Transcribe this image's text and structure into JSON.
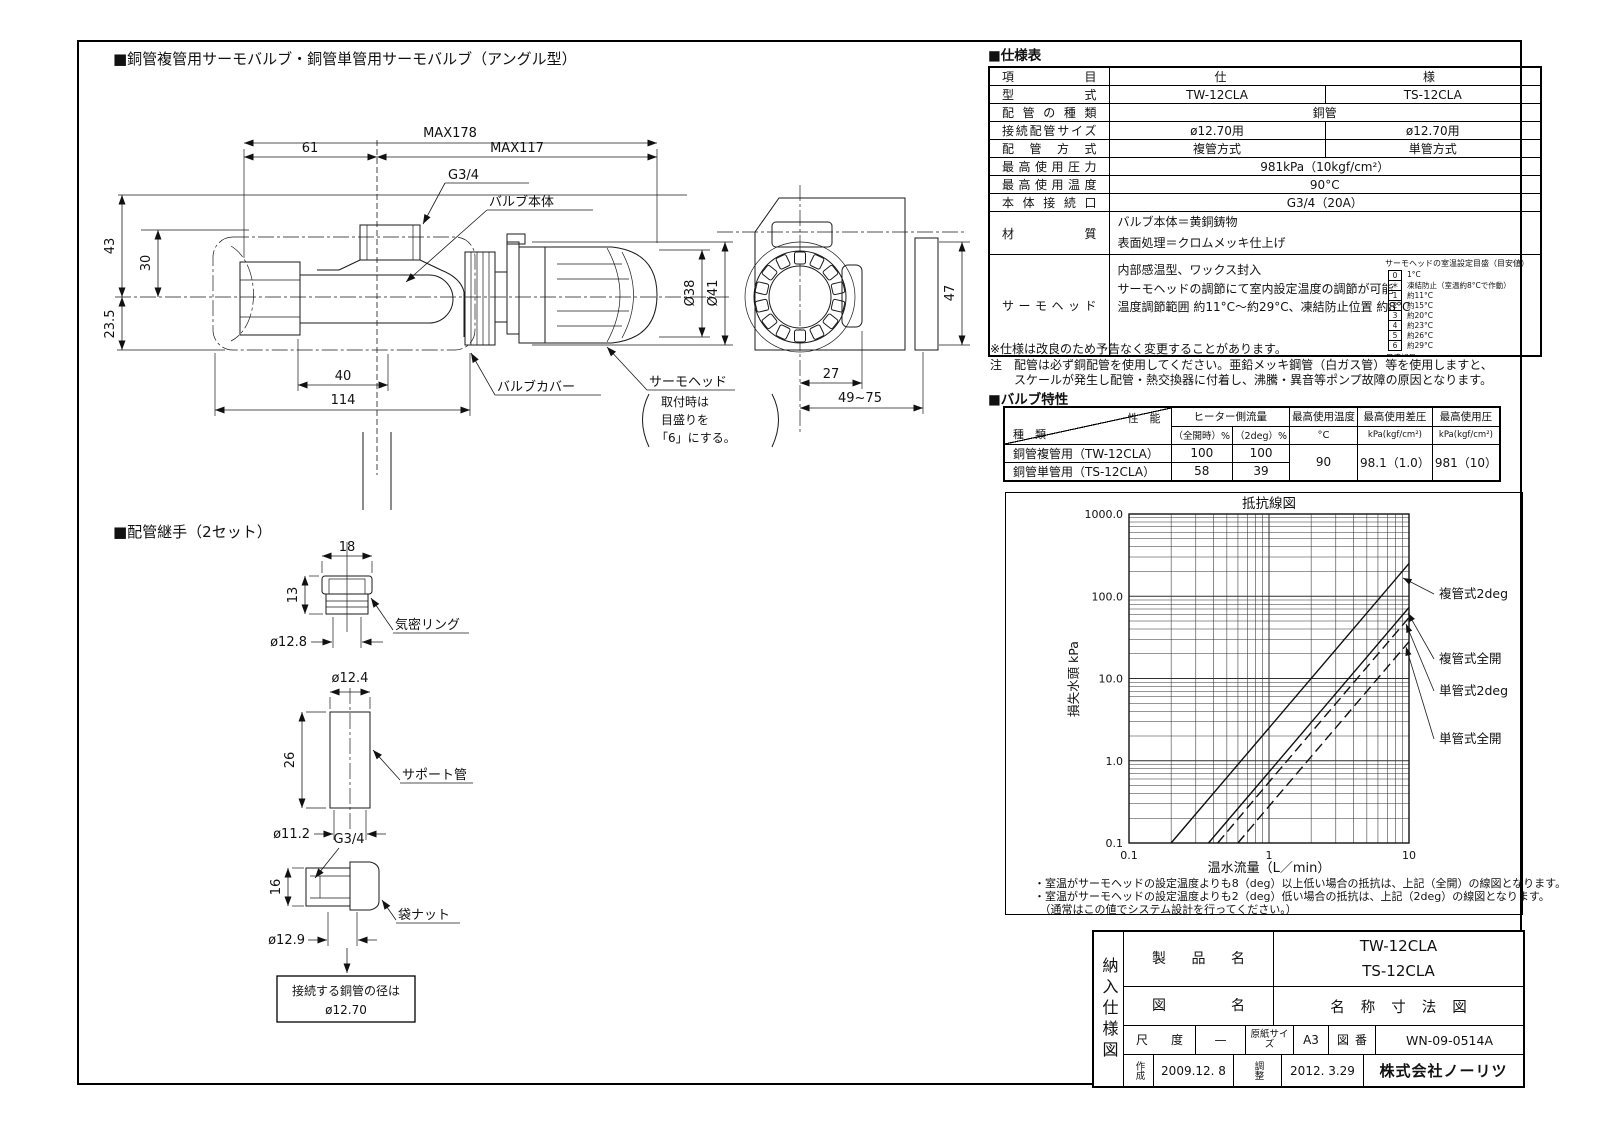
{
  "drawing": {
    "title": "■銅管複管用サーモバルブ・銅管単管用サーモバルブ（アングル型）",
    "max178": "MAX178",
    "d61": "61",
    "max117": "MAX117",
    "g34": "G3/4",
    "valve_body": "バルブ本体",
    "valve_cover": "バルブカバー",
    "d43": "43",
    "d30": "30",
    "d23_5": "23.5",
    "d40": "40",
    "d114": "114",
    "dia38": "Ø38",
    "dia41": "Ø41",
    "thermo_head": "サーモヘッド",
    "head_note1": "取付時は",
    "head_note2": "目盛りを",
    "head_note3": "「6」にする。",
    "d27": "27",
    "d49_75": "49~75",
    "d47": "47"
  },
  "fittings": {
    "title": "■配管継手（2セット）",
    "d18": "18",
    "d13": "13",
    "dia12_8": "ø12.8",
    "ring": "気密リング",
    "dia12_4": "ø12.4",
    "d26": "26",
    "dia11_2": "ø11.2",
    "support": "サポート管",
    "g34": "G3/4",
    "d16": "16",
    "dia12_9": "ø12.9",
    "nut": "袋ナット",
    "note1": "接続する銅管の径は",
    "note2": "ø12.70"
  },
  "spec": {
    "title": "■仕様表",
    "header_item": "項目",
    "header_spec": "仕様",
    "rows": [
      {
        "label": "型式",
        "a": "TW-12CLA",
        "b": "TS-12CLA"
      },
      {
        "label": "配管の種類",
        "span": "銅管"
      },
      {
        "label": "接続配管サイズ",
        "a": "ø12.70用",
        "b": "ø12.70用"
      },
      {
        "label": "配管方式",
        "a": "複管方式",
        "b": "単管方式"
      },
      {
        "label": "最高使用圧力",
        "span": "981kPa（10kgf/cm²）"
      },
      {
        "label": "最高使用温度",
        "span": "90°C"
      },
      {
        "label": "本体接続口",
        "span": "G3/4（20A）"
      }
    ],
    "material_label": "材質",
    "material_lines": [
      "バルブ本体＝黄銅鋳物",
      "表面処理＝クロムメッキ仕上げ"
    ],
    "thermo_label": "サーモヘッド",
    "thermo_lines": [
      "内部感温型、ワックス封入",
      "サーモヘッドの調節にて室内設定温度の調節が可能",
      "温度調節範囲 約11°C〜約29°C、凍結防止位置 約8°C"
    ],
    "scale_box": {
      "title": "サーモヘッドの室温設定目盛（目安値）",
      "footer": "目盛記号",
      "rows": [
        {
          "k": "0",
          "v": "1°C"
        },
        {
          "k": "＊",
          "v": "凍結防止（室温約8°Cで作動）"
        },
        {
          "k": "1",
          "v": "約11°C"
        },
        {
          "k": "2",
          "v": "約15°C"
        },
        {
          "k": "3",
          "v": "約20°C"
        },
        {
          "k": "4",
          "v": "約23°C"
        },
        {
          "k": "5",
          "v": "約26°C"
        },
        {
          "k": "6",
          "v": "約29°C"
        }
      ]
    },
    "notes": [
      "※仕様は改良のため予告なく変更することがあります。",
      "注　配管は必ず銅配管を使用してください。亜鉛メッキ鋼管（白ガス管）等を使用しますと、",
      "　　スケールが発生し配管・熱交換器に付着し、沸騰・異音等ポンプ故障の原因となります。"
    ]
  },
  "vchar": {
    "title": "■バルブ特性",
    "diag_top": "性　能",
    "diag_bottom": "種　類",
    "flow_header": "ヒーター側流量",
    "flow_sub_a": "（全開時）%",
    "flow_sub_b": "（2deg）%",
    "temp_header": "最高使用温度",
    "temp_unit": "°C",
    "dp_header": "最高使用差圧",
    "dp_unit": "kPa(kgf/cm²)",
    "p_header": "最高使用圧",
    "p_unit": "kPa(kgf/cm²)",
    "rows": [
      {
        "name": "銅管複管用（TW-12CLA）",
        "full": "100",
        "deg2": "100"
      },
      {
        "name": "銅管単管用（TS-12CLA）",
        "full": "58",
        "deg2": "39"
      }
    ],
    "temp": "90",
    "dp": "98.1（1.0）",
    "p": "981（10）"
  },
  "chart_data": {
    "type": "line",
    "title": "抵抗線図",
    "xlabel": "温水流量（L／min）",
    "ylabel": "損失水頭 kPa",
    "xscale": "log",
    "yscale": "log",
    "xlim": [
      0.1,
      10
    ],
    "ylim": [
      0.1,
      1000
    ],
    "xticks": [
      0.1,
      1,
      10
    ],
    "yticks": [
      1000,
      100,
      10,
      1,
      0.1
    ],
    "xtick_labels": [
      "0.1",
      "1",
      "10"
    ],
    "ytick_labels": [
      "1000.0",
      "100.0",
      "10.0",
      "1.0",
      "0.1"
    ],
    "grid": true,
    "legend_position": "right",
    "series": [
      {
        "name": "複管式2deg",
        "line": "solid",
        "x": [
          0.2,
          1,
          10
        ],
        "y": [
          0.1,
          2.5,
          250
        ]
      },
      {
        "name": "複管式全開",
        "line": "solid",
        "x": [
          0.37,
          1,
          10
        ],
        "y": [
          0.1,
          0.73,
          73
        ]
      },
      {
        "name": "単管式2deg",
        "line": "dashed",
        "x": [
          0.43,
          1,
          10
        ],
        "y": [
          0.1,
          0.55,
          55
        ]
      },
      {
        "name": "単管式全開",
        "line": "dashed",
        "x": [
          0.6,
          1,
          10
        ],
        "y": [
          0.1,
          0.28,
          28
        ]
      }
    ]
  },
  "chart_notes": [
    "・室温がサーモヘッドの設定温度よりも8（deg）以上低い場合の抵抗は、上記（全開）の線図となります。",
    "・室温がサーモヘッドの設定温度よりも2（deg）低い場合の抵抗は、上記（2deg）の線図となります。",
    "　（通常はこの値でシステム設計を行ってください。）"
  ],
  "title_block": {
    "side_label": "納入仕様図",
    "product_label": "製品名",
    "product_value1": "TW-12CLA",
    "product_value2": "TS-12CLA",
    "drawing_label": "図名",
    "drawing_value": "名称寸法図",
    "scale_label": "尺度",
    "scale_value": "—",
    "paper_label": "原紙サイズ",
    "paper_value": "A3",
    "number_label": "図番",
    "number_value": "WN-09-0514A",
    "created_label": "作成",
    "created_value": "2009.12. 8",
    "adjusted_label": "調整",
    "adjusted_value": "2012. 3.29",
    "company": "株式会社ノーリツ"
  }
}
